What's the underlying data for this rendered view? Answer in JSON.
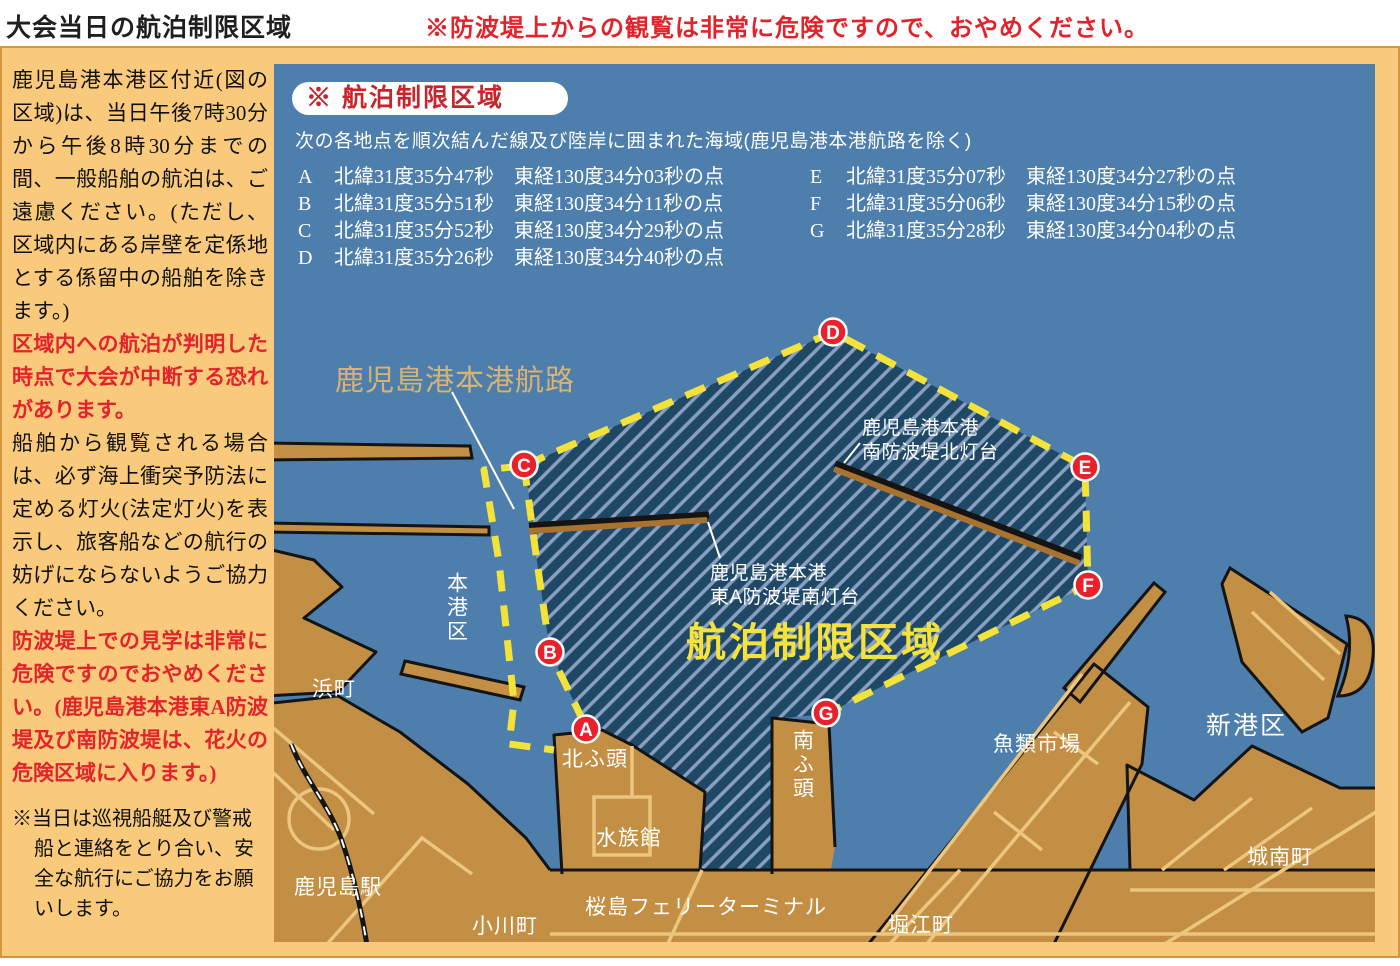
{
  "header": {
    "title": "大会当日の航泊制限区域",
    "warning": "※防波堤上からの観覧は非常に危険ですので、おやめください。"
  },
  "sidebar": {
    "p1": "鹿児島港本港区付近(図の区域)は、当日午後7時30分から午後8時30分までの間、一般船舶の航泊は、ご遠慮ください。(ただし、区域内にある岸壁を定係地とする係留中の船舶を除きます。)",
    "p2": "区域内への航泊が判明した時点で大会が中断する恐れがあります。",
    "p3": "船舶から観覧される場合は、必ず海上衝突予防法に定める灯火(法定灯火)を表示し、旅客船などの航行の妨げにならないようご協力ください。",
    "p4": "防波堤上での見学は非常に危険ですのでおやめください。(鹿児島港本港東A防波堤及び南防波堤は、花火の危険区域に入ります。)",
    "note": "※当日は巡視船艇及び警戒船と連絡をとり合い、安全な航行にご協力をお願いします。"
  },
  "legend": {
    "badge": "※ 航泊制限区域",
    "description": "次の各地点を順次結んだ線及び陸岸に囲まれた海域(鹿児島港本港航路を除く)",
    "points": [
      {
        "id": "A",
        "lat": "北緯31度35分47秒",
        "lon": "東経130度34分03秒の点"
      },
      {
        "id": "B",
        "lat": "北緯31度35分51秒",
        "lon": "東経130度34分11秒の点"
      },
      {
        "id": "C",
        "lat": "北緯31度35分52秒",
        "lon": "東経130度34分29秒の点"
      },
      {
        "id": "D",
        "lat": "北緯31度35分26秒",
        "lon": "東経130度34分40秒の点"
      },
      {
        "id": "E",
        "lat": "北緯31度35分07秒",
        "lon": "東経130度34分27秒の点"
      },
      {
        "id": "F",
        "lat": "北緯31度35分06秒",
        "lon": "東経130度34分15秒の点"
      },
      {
        "id": "G",
        "lat": "北緯31度35分28秒",
        "lon": "東経130度34分04秒の点"
      }
    ]
  },
  "map": {
    "zone_label": "航泊制限区域",
    "channel_label": "鹿児島港本港航路",
    "lighthouse_north": {
      "line1": "鹿児島港本港",
      "line2": "南防波堤北灯台"
    },
    "lighthouse_east_a": {
      "line1": "鹿児島港本港",
      "line2": "東A防波堤南灯台"
    },
    "markers": {
      "a": "A",
      "b": "B",
      "c": "C",
      "d": "D",
      "e": "E",
      "f": "F",
      "g": "G"
    },
    "places": {
      "honkoku": "本港区",
      "hamacho": "浜町",
      "kitafuto": "北ふ頭",
      "minamifuto": "南ふ頭",
      "suizokukan": "水族館",
      "ferry": "桜島フェリーターミナル",
      "kagoshima_station": "鹿児島駅",
      "ogawacho": "小川町",
      "horiecho": "堀江町",
      "gyorui_ichiba": "魚類市場",
      "shinkoku": "新港区",
      "jonancho": "城南町"
    },
    "colors": {
      "sea": "#4d7eac",
      "land": "#c28f45",
      "road": "#ecc57f",
      "zone_fill": "#1e4866",
      "zone_stripe": "#8aa0c0",
      "dash_border": "#f2e23a",
      "marker_red": "#e8212b",
      "zone_text": "#f5e33c",
      "channel_text": "#d9b372",
      "warning_red": "#e3232b"
    }
  }
}
